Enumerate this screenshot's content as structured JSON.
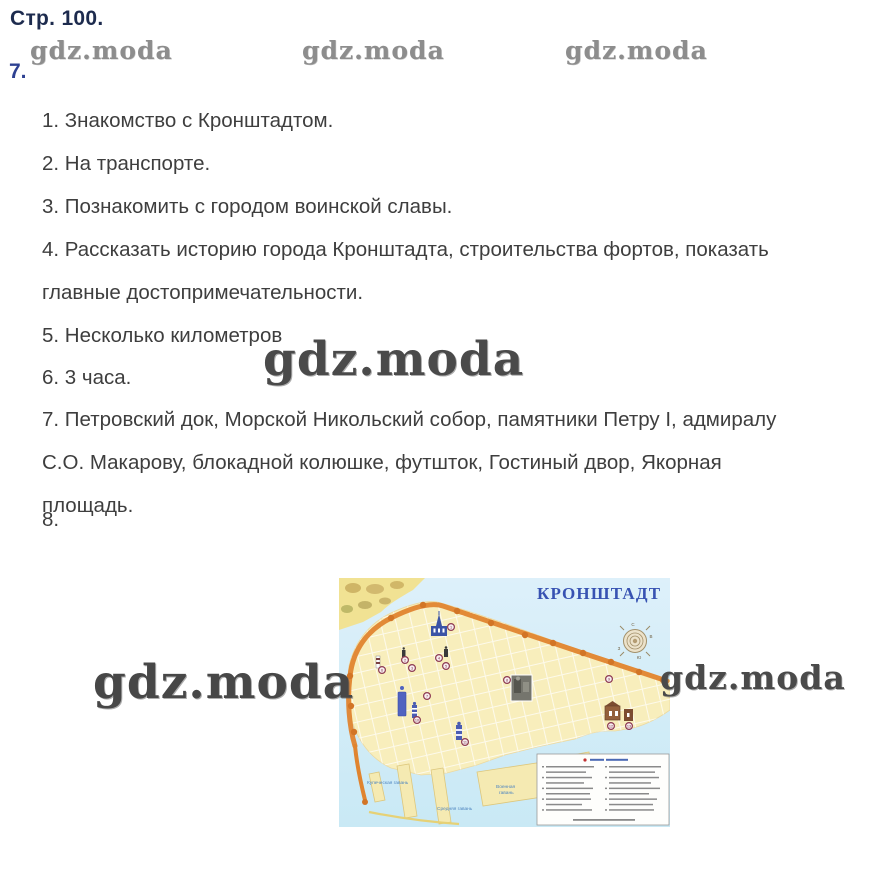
{
  "page": {
    "header": "Стр. 100.",
    "section7": "7.",
    "section8": "8."
  },
  "watermark_text": "gdz.moda",
  "answers": [
    {
      "lines": [
        "1. Знакомство с Кронштадтом."
      ]
    },
    {
      "lines": [
        "2. На транспорте."
      ]
    },
    {
      "lines": [
        "3. Познакомить с городом воинской славы."
      ]
    },
    {
      "lines": [
        "4. Рассказать историю города Кронштадта, строительства фортов, показать",
        "главные достопримечательности."
      ]
    },
    {
      "lines": [
        "5. Несколько километров"
      ]
    },
    {
      "lines": [
        "6. 3 часа."
      ]
    },
    {
      "lines": [
        "7. Петровский док, Морской Никольский собор, памятники Петру I, адмиралу",
        "С.О. Макарову, блокадной колюшке, футшток, Гостиный двор, Якорная",
        "площадь."
      ]
    }
  ],
  "map": {
    "title": "КРОНШТАДТ",
    "compass": {
      "n": "С",
      "s": "Ю",
      "w": "З",
      "e": "В"
    },
    "labels": {
      "harbor_west": "Купеческая гавань",
      "harbor_mid": "Средняя гавань",
      "harbor_east_1": "Военная",
      "harbor_east_2": "гавань"
    },
    "markers": [
      "1",
      "2",
      "3",
      "4",
      "5",
      "6",
      "7",
      "8",
      "9",
      "10",
      "11",
      "12",
      "13"
    ],
    "colors": {
      "water": "#d7edf8",
      "land": "#f8eebc",
      "wall_orange": "#e0842f",
      "title_blue": "#3752b2",
      "marker_maroon": "#8d3a52"
    }
  }
}
